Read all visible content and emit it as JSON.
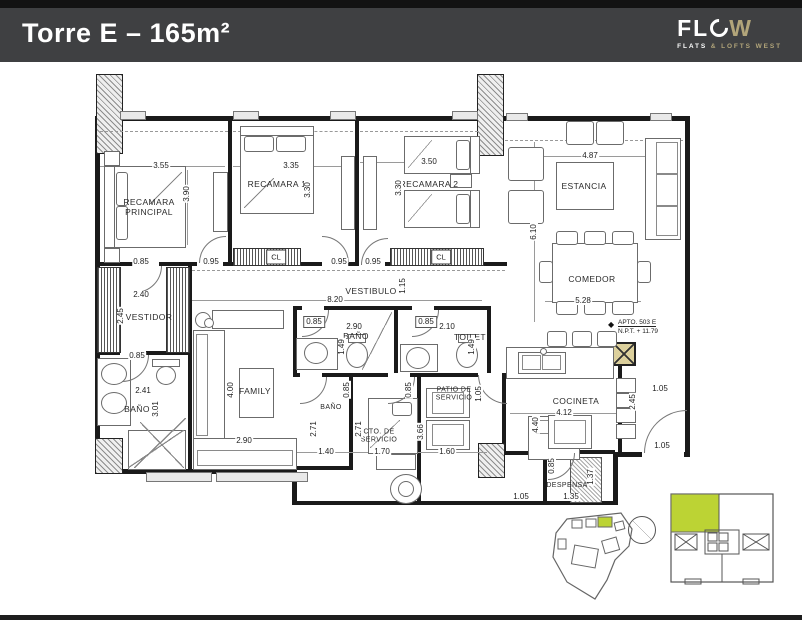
{
  "header": {
    "title": "Torre E – 165m²",
    "logo": {
      "fl": "FL",
      "w": "W",
      "tag_flats": "FLATS",
      "tag_amp": "&",
      "tag_rest": "LOFTS WEST"
    }
  },
  "plan": {
    "rooms": [
      {
        "label": "RECAMARA\nPRINCIPAL"
      },
      {
        "label": "RECAMARA 1"
      },
      {
        "label": "RECAMARA 2"
      },
      {
        "label": "ESTANCIA"
      },
      {
        "label": "COMEDOR"
      },
      {
        "label": "VESTIBULO"
      },
      {
        "label": "VESTIDOR"
      },
      {
        "label": "BAÑO"
      },
      {
        "label": "FAMILY"
      },
      {
        "label": "BAÑO"
      },
      {
        "label": "TOILET"
      },
      {
        "label": "BAÑO"
      },
      {
        "label": "CTO. DE\nSERVICIO"
      },
      {
        "label": "PATIO DE\nSERVICIO"
      },
      {
        "label": "COCINETA"
      },
      {
        "label": "DESPENSA"
      }
    ],
    "cl": "CL",
    "dims": [
      "3.55",
      "3.90",
      "0.85",
      "0.95",
      "3.35",
      "3.30",
      "0.95",
      "0.95",
      "3.50",
      "3.30",
      "4.87",
      "6.10",
      "5.28",
      "2.40",
      "2.45",
      "0.85",
      "2.41",
      "3.01",
      "8.20",
      "1.15",
      "0.85",
      "2.90",
      "1.49",
      "0.85",
      "2.10",
      "1.49",
      "1.05",
      "0.85",
      "0.85",
      "2.71",
      "2.71",
      "1.40",
      "1.70",
      "1.60",
      "3.66",
      "2.90",
      "4.00",
      "4.12",
      "4.40",
      "2.45",
      "1.05",
      "1.05",
      "0.85",
      "1.37",
      "1.35",
      "1.05"
    ],
    "annotations": {
      "apto": "APTO. 503 E",
      "npt": "N.P.T. + 11.79",
      "level_icon": "◆"
    }
  },
  "colors": {
    "header_bg": "#3F4042",
    "logo_gold": "#B2A57A",
    "unit_green": "#BCD334",
    "column_tan": "#DCD09C"
  }
}
